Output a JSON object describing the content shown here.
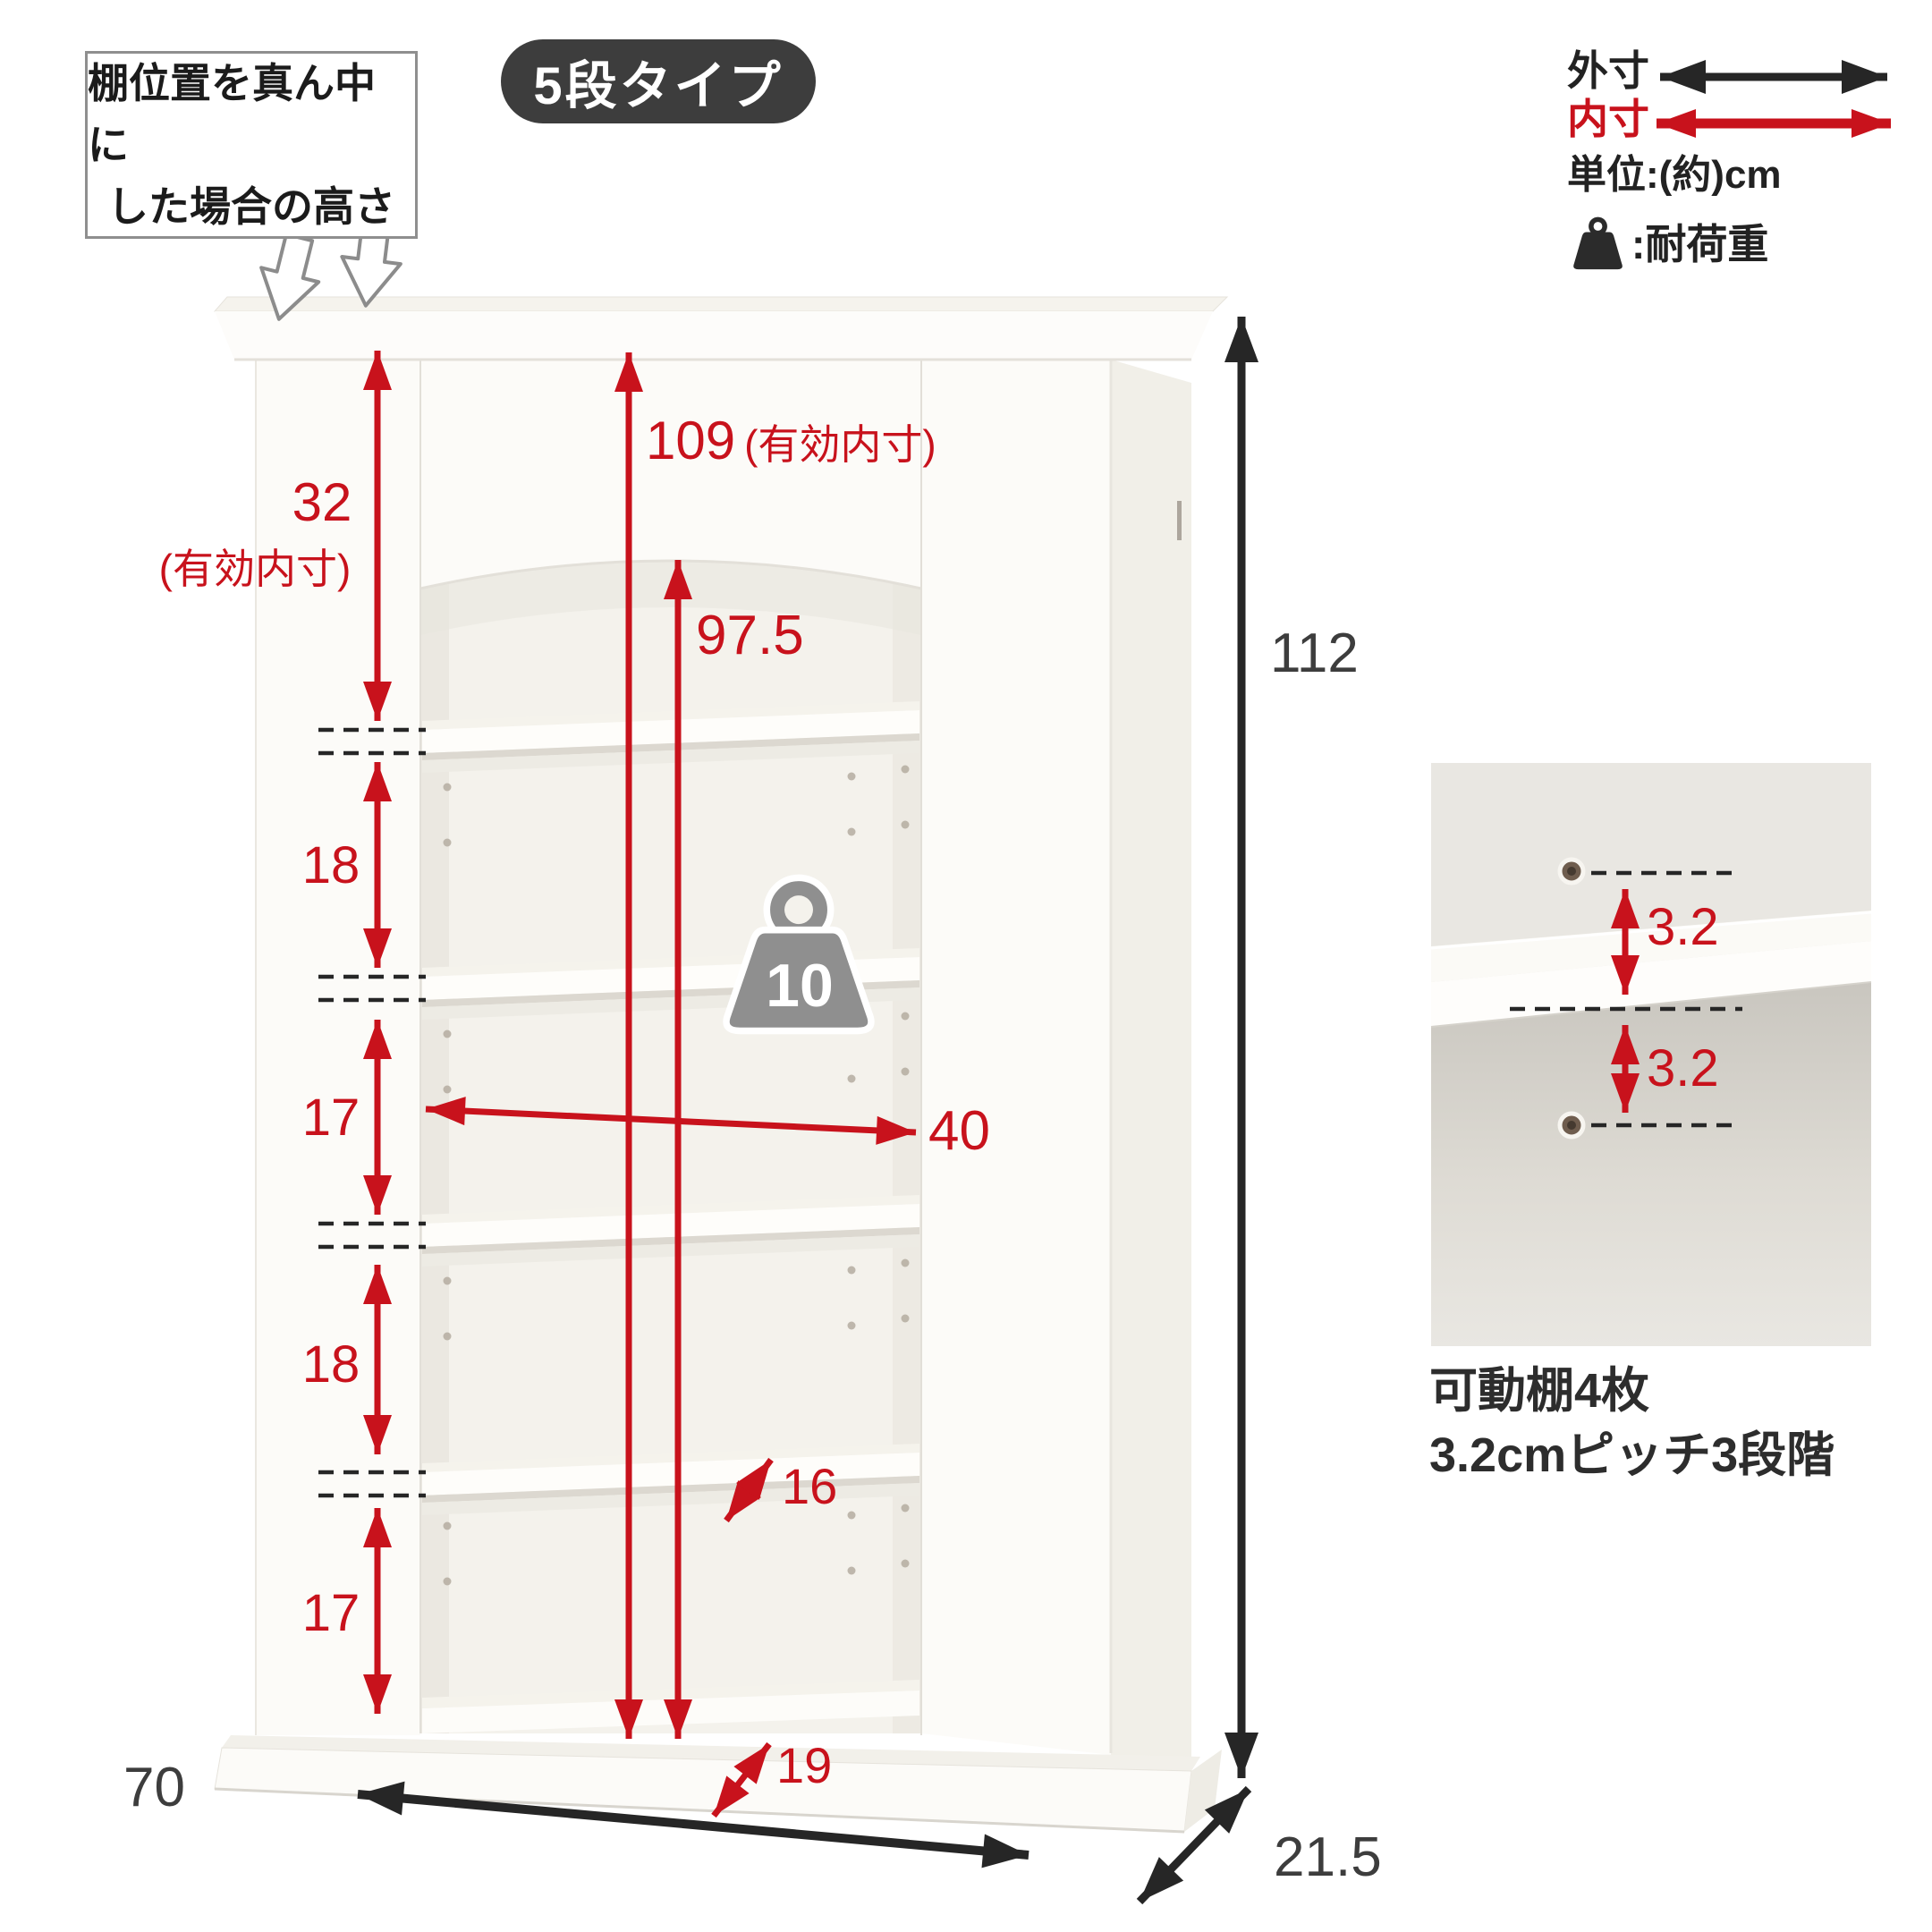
{
  "badge": {
    "label": "5段タイプ"
  },
  "callout": {
    "line1": "棚位置を真ん中に",
    "line2": "した場合の高さ"
  },
  "legend": {
    "outer_label": "外寸",
    "inner_label": "内寸",
    "unit_label": "単位:(約)cm",
    "load_label": ":耐荷重",
    "outer_color": "#262626",
    "inner_color": "#c8121c"
  },
  "dimensions": {
    "top_opening": "32",
    "top_opening_note": "(有効内寸)",
    "interior_height": "109",
    "interior_height_note": "(有効内寸)",
    "arch_height": "97.5",
    "gap_1": "18",
    "gap_2": "17",
    "gap_3": "18",
    "gap_4": "17",
    "interior_width": "40",
    "shelf_depth": "16",
    "base_depth": "19",
    "overall_height": "112",
    "overall_width": "70",
    "overall_depth": "21.5"
  },
  "load_capacity": "10",
  "detail": {
    "pitch_upper": "3.2",
    "pitch_lower": "3.2",
    "caption_line1": "可動棚4枚",
    "caption_line2": "3.2cmピッチ3段階"
  },
  "icons": {
    "load": "weight-icon",
    "outer_arrow": "double-arrow-icon",
    "inner_arrow": "double-arrow-icon",
    "callout_arrow": "down-arrow-icon"
  },
  "colors": {
    "accent_red": "#c8121c",
    "arrow_black": "#262626",
    "badge_bg": "#3d3d3d",
    "detail_panel_bg": "#e9e7e2",
    "cabinet_white": "#fcfbf8"
  }
}
